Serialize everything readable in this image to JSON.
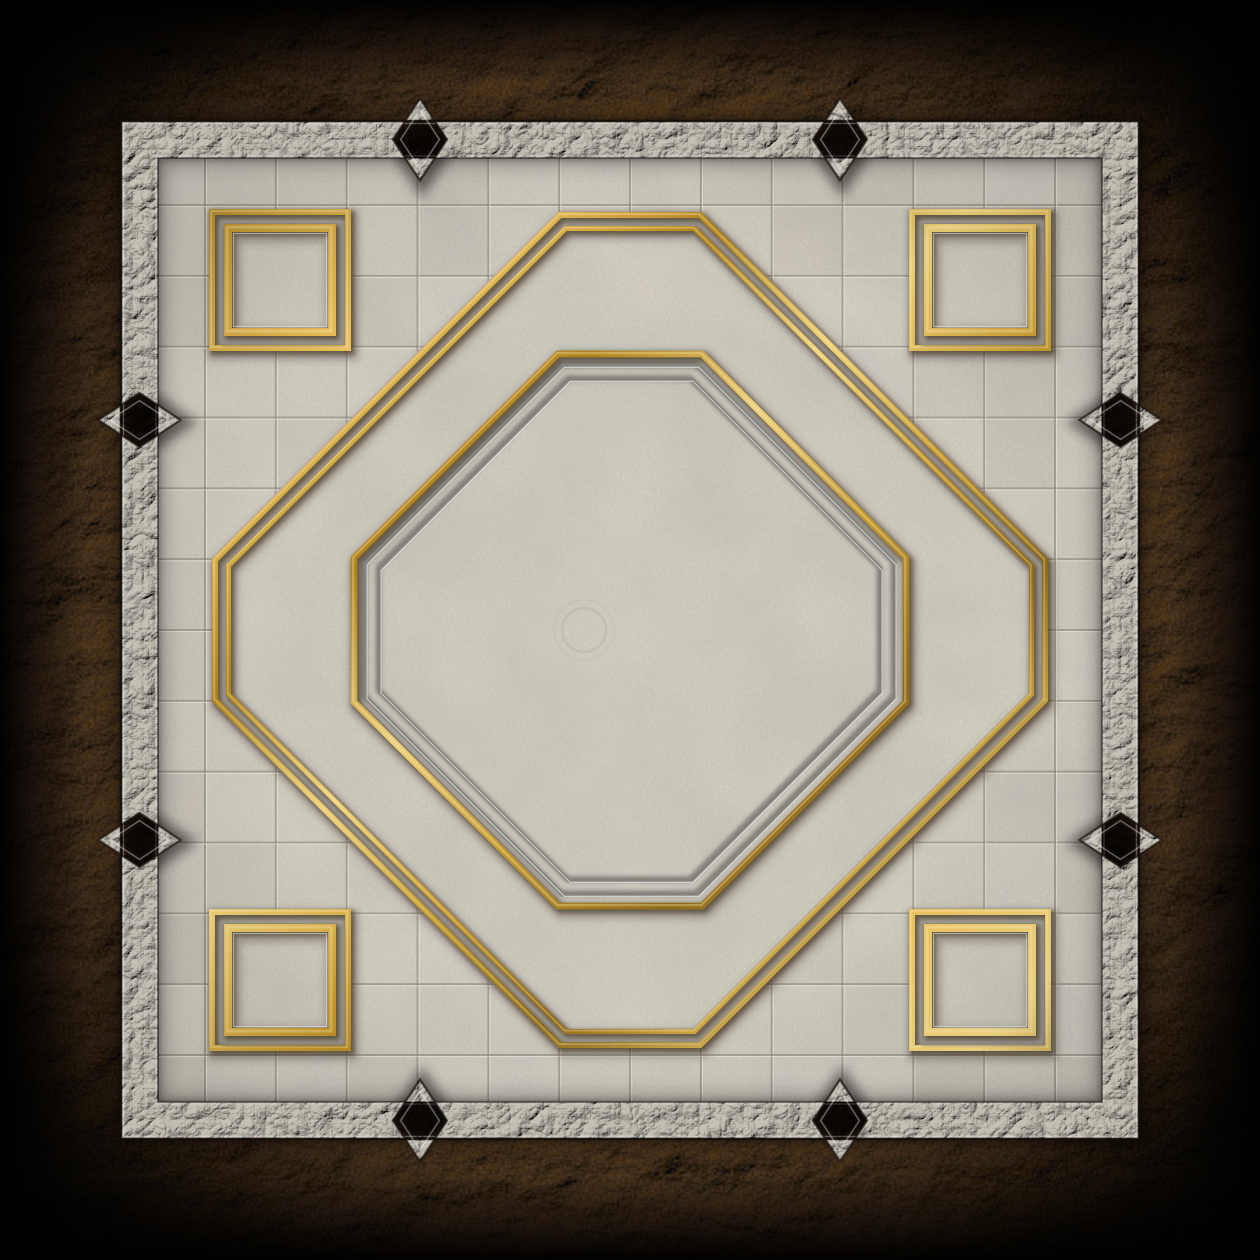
{
  "scene": {
    "kind": "dungeon-floor-tile-battle-map",
    "canvas": {
      "width": 1260,
      "height": 1260
    },
    "palette": {
      "void": "#000000",
      "rock": {
        "center": "#7b624a",
        "mid": "#6b5136",
        "deep": "#4e3a22",
        "dark": "#2c1f10",
        "edge": "#140d06",
        "light": "#c2a97e"
      },
      "stone": {
        "base": "#c6c1b6",
        "light": "#ffffff",
        "crack_r": 0.12,
        "crack_g": 0.1,
        "crack_b": 0.07,
        "edge_dark": "#120d07",
        "edge_light": "rgba(255,255,252,0.3)",
        "inner_dark": "rgba(0,0,0,0.4)"
      },
      "marble": {
        "base": "#d6d1c4",
        "vein_r": 0.55,
        "vein_g": 0.53,
        "vein_b": 0.48,
        "grid_line": "#8b877b",
        "grid_highlight": "#f7f4ea",
        "tint_light": "#ffffff",
        "tint_dark": "#6e6a5e"
      },
      "gold": {
        "stops": [
          "#8a6418",
          "#caa139",
          "#eec45e",
          "#b08118",
          "#f0d278",
          "#c89a2c",
          "#8f6a16",
          "#e8bf58",
          "#f6dc86",
          "#9a7420"
        ],
        "shadow": "rgba(42,28,6,0.5)",
        "glint": "rgba(255,243,200,0.32)"
      },
      "grey_inlay": {
        "main": "#85857e",
        "dark": "rgba(68,66,58,0.6)",
        "light": "rgba(255,255,250,0.55)"
      },
      "inlay_soft_shadow": "rgba(80,74,62,0.38)"
    },
    "frame": {
      "outer_inset": 121,
      "thickness": 37,
      "diamond_offsets": [
        420,
        840
      ],
      "diamond_half_across": 41,
      "diamond_half_along": 27
    },
    "floor": {
      "inset": 158,
      "grid_first": 205,
      "grid_last": 1055,
      "grid_count": 13
    },
    "inlays": {
      "outer_octagon": {
        "inset": 215,
        "corner_cut": 345,
        "second_offset": 13.5,
        "width1": 6,
        "width2": 5
      },
      "inner_octagon": {
        "inset": 354,
        "corner_cut": 204,
        "gold_width": 6.5,
        "grey_offsets": [
          11.5,
          25.5
        ],
        "grey_width": 4
      },
      "corner_squares": {
        "inset": 209,
        "size": 142,
        "outer_stroke": 6,
        "inner_center_inset": 19,
        "inner_stroke": 8
      },
      "center_ring": {
        "cx": 584,
        "cy": 630,
        "r1": 22,
        "r2": 30
      }
    },
    "tint_seed": 12
  }
}
